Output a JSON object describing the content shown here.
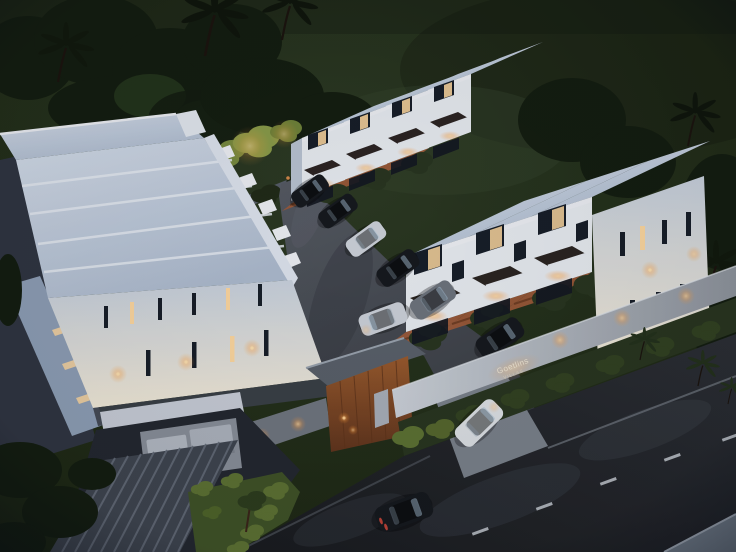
{
  "scene": {
    "description": "Dusk aerial 3D rendering of a gated residential estate: two stepped rows of white three-storey townhouses face a central paved driveway with terracotta carports, hedge dividers and parked cars; a larger white apartment block with stepped flat roofs sits on the left; a timber-clad entrance gatehouse and an illuminated estate sign face the foreground street where cars drive past lawns, gardens and palm trees.",
    "time_of_day": "dusk",
    "setting": "residential estate aerial view"
  },
  "estate_sign": {
    "line1": "Goetlins",
    "line2": "VILLAS"
  },
  "counts": {
    "townhouse_units_visible": 7,
    "parked_cars": 6,
    "moving_cars": 3,
    "palm_trees": 6
  },
  "palette": {
    "grass": "#2c3a22",
    "grass_dark": "#19230f",
    "foliage_dark": "#131c0e",
    "foliage_green": "#26371c",
    "foliage_lit": "#839543",
    "roof": "#aebccf",
    "roof_light": "#d7e0ec",
    "fascia": "#eef1f5",
    "wall_white": "#c9d2dd",
    "wall_warm": "#f4ecd9",
    "wall_shadow": "#9aa6b5",
    "window_dark": "#161d27",
    "window_lit": "#ffd9a0",
    "glow": "#ffc97e",
    "driveway": "#555a62",
    "driveway_dark": "#383c42",
    "pad": "#9d5a38",
    "hedge": "#28351e",
    "hedge_lit": "#5d7231",
    "lawn_lit": "#3f5226",
    "concrete": "#70767f",
    "concrete_dark": "#565c66",
    "wood": "#9a5a2c",
    "wood_dark": "#60341b",
    "metal": "#a9b0b9",
    "street": "#2b2e33",
    "street_dark": "#181a1d",
    "marking": "#c9ced4",
    "sidewalk": "#76828f",
    "curb": "#6a7078",
    "car_dark": "#15181c",
    "car_grey": "#6d737c",
    "car_silver": "#cdd2d9",
    "car_white": "#dfe3e6",
    "taillight": "#d2473a"
  }
}
